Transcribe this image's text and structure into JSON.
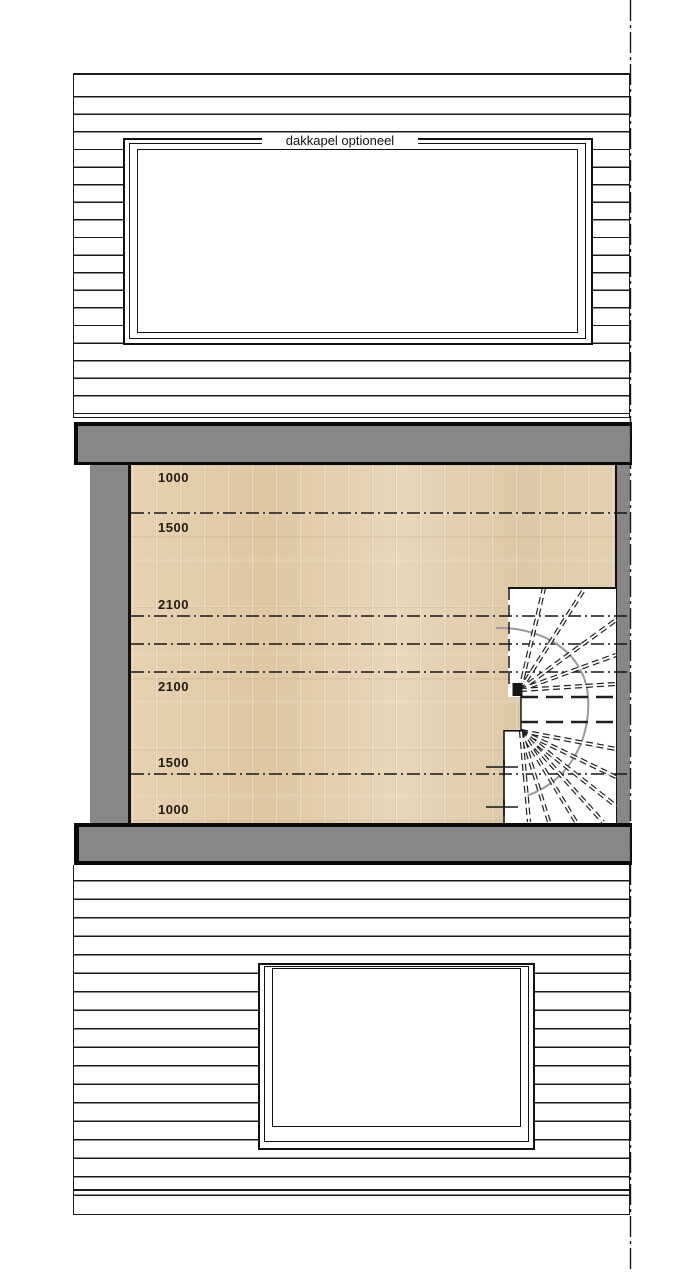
{
  "drawing": {
    "type": "architectural floor plan - attic storey with optional dormer and spiral stair",
    "dormer_label": "dakkapel optioneel",
    "headroom_labels": [
      {
        "value": "1000"
      },
      {
        "value": "1500"
      },
      {
        "value": "2100"
      },
      {
        "value": "2100"
      },
      {
        "value": "1500"
      },
      {
        "value": "1000"
      }
    ],
    "contour_line_y": [
      513,
      616,
      644,
      672,
      774
    ]
  },
  "colors": {
    "wall_gray": "#878787",
    "wood_base": "#e2ccaa",
    "line_black": "#1a1a1a",
    "walkline_gray": "#9a9a9a"
  }
}
